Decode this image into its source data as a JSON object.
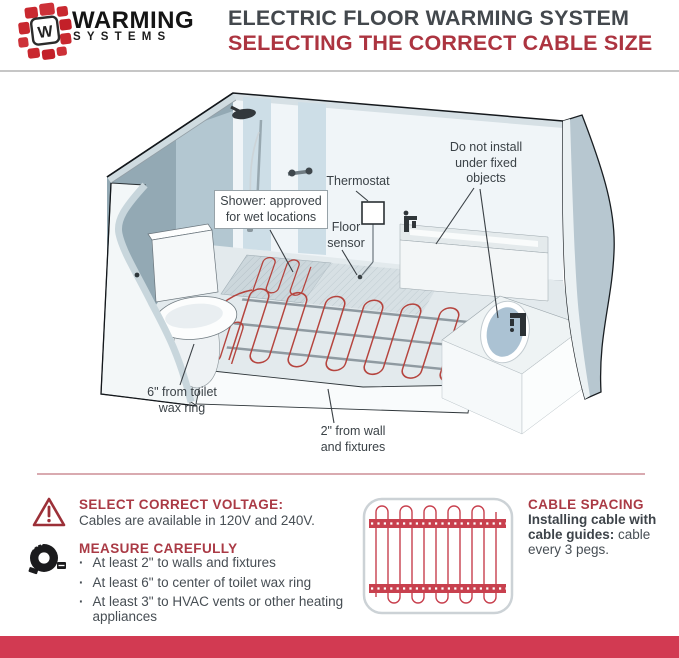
{
  "header": {
    "logo_monogram": "W",
    "brand_top": "WARMING",
    "brand_bottom": "SYSTEMS",
    "title": "ELECTRIC FLOOR WARMING SYSTEM",
    "subtitle": "SELECTING THE CORRECT CABLE SIZE"
  },
  "diagram": {
    "labels": {
      "shower_line1": "Shower: approved",
      "shower_line2": "for wet locations",
      "thermostat": "Thermostat",
      "sensor_line1": "Floor",
      "sensor_line2": "sensor",
      "fixed_line1": "Do not install",
      "fixed_line2": "under fixed",
      "fixed_line3": "objects",
      "toilet_line1": "6\" from toilet",
      "toilet_line2": "wax ring",
      "wall_line1": "2\" from wall",
      "wall_line2": "and fixtures"
    }
  },
  "info": {
    "voltage_heading": "SELECT CORRECT VOLTAGE:",
    "voltage_body": "Cables are available in 120V and 240V.",
    "measure_heading": "MEASURE CAREFULLY",
    "bullet_char": "·",
    "bullets": [
      "At least 2\" to walls and fixtures",
      "At least 6\" to center of toilet wax ring",
      "At least 3\" to HVAC vents or other heating appliances"
    ],
    "spacing_heading": "CABLE SPACING",
    "spacing_bold": "Installing cable with cable guides:",
    "spacing_rest": " cable every 3 pegs."
  },
  "colors": {
    "accent_red": "#aa3a45",
    "logo_red": "#c9282f",
    "footer_red": "#d23a52",
    "cable_red": "#b5443e"
  }
}
